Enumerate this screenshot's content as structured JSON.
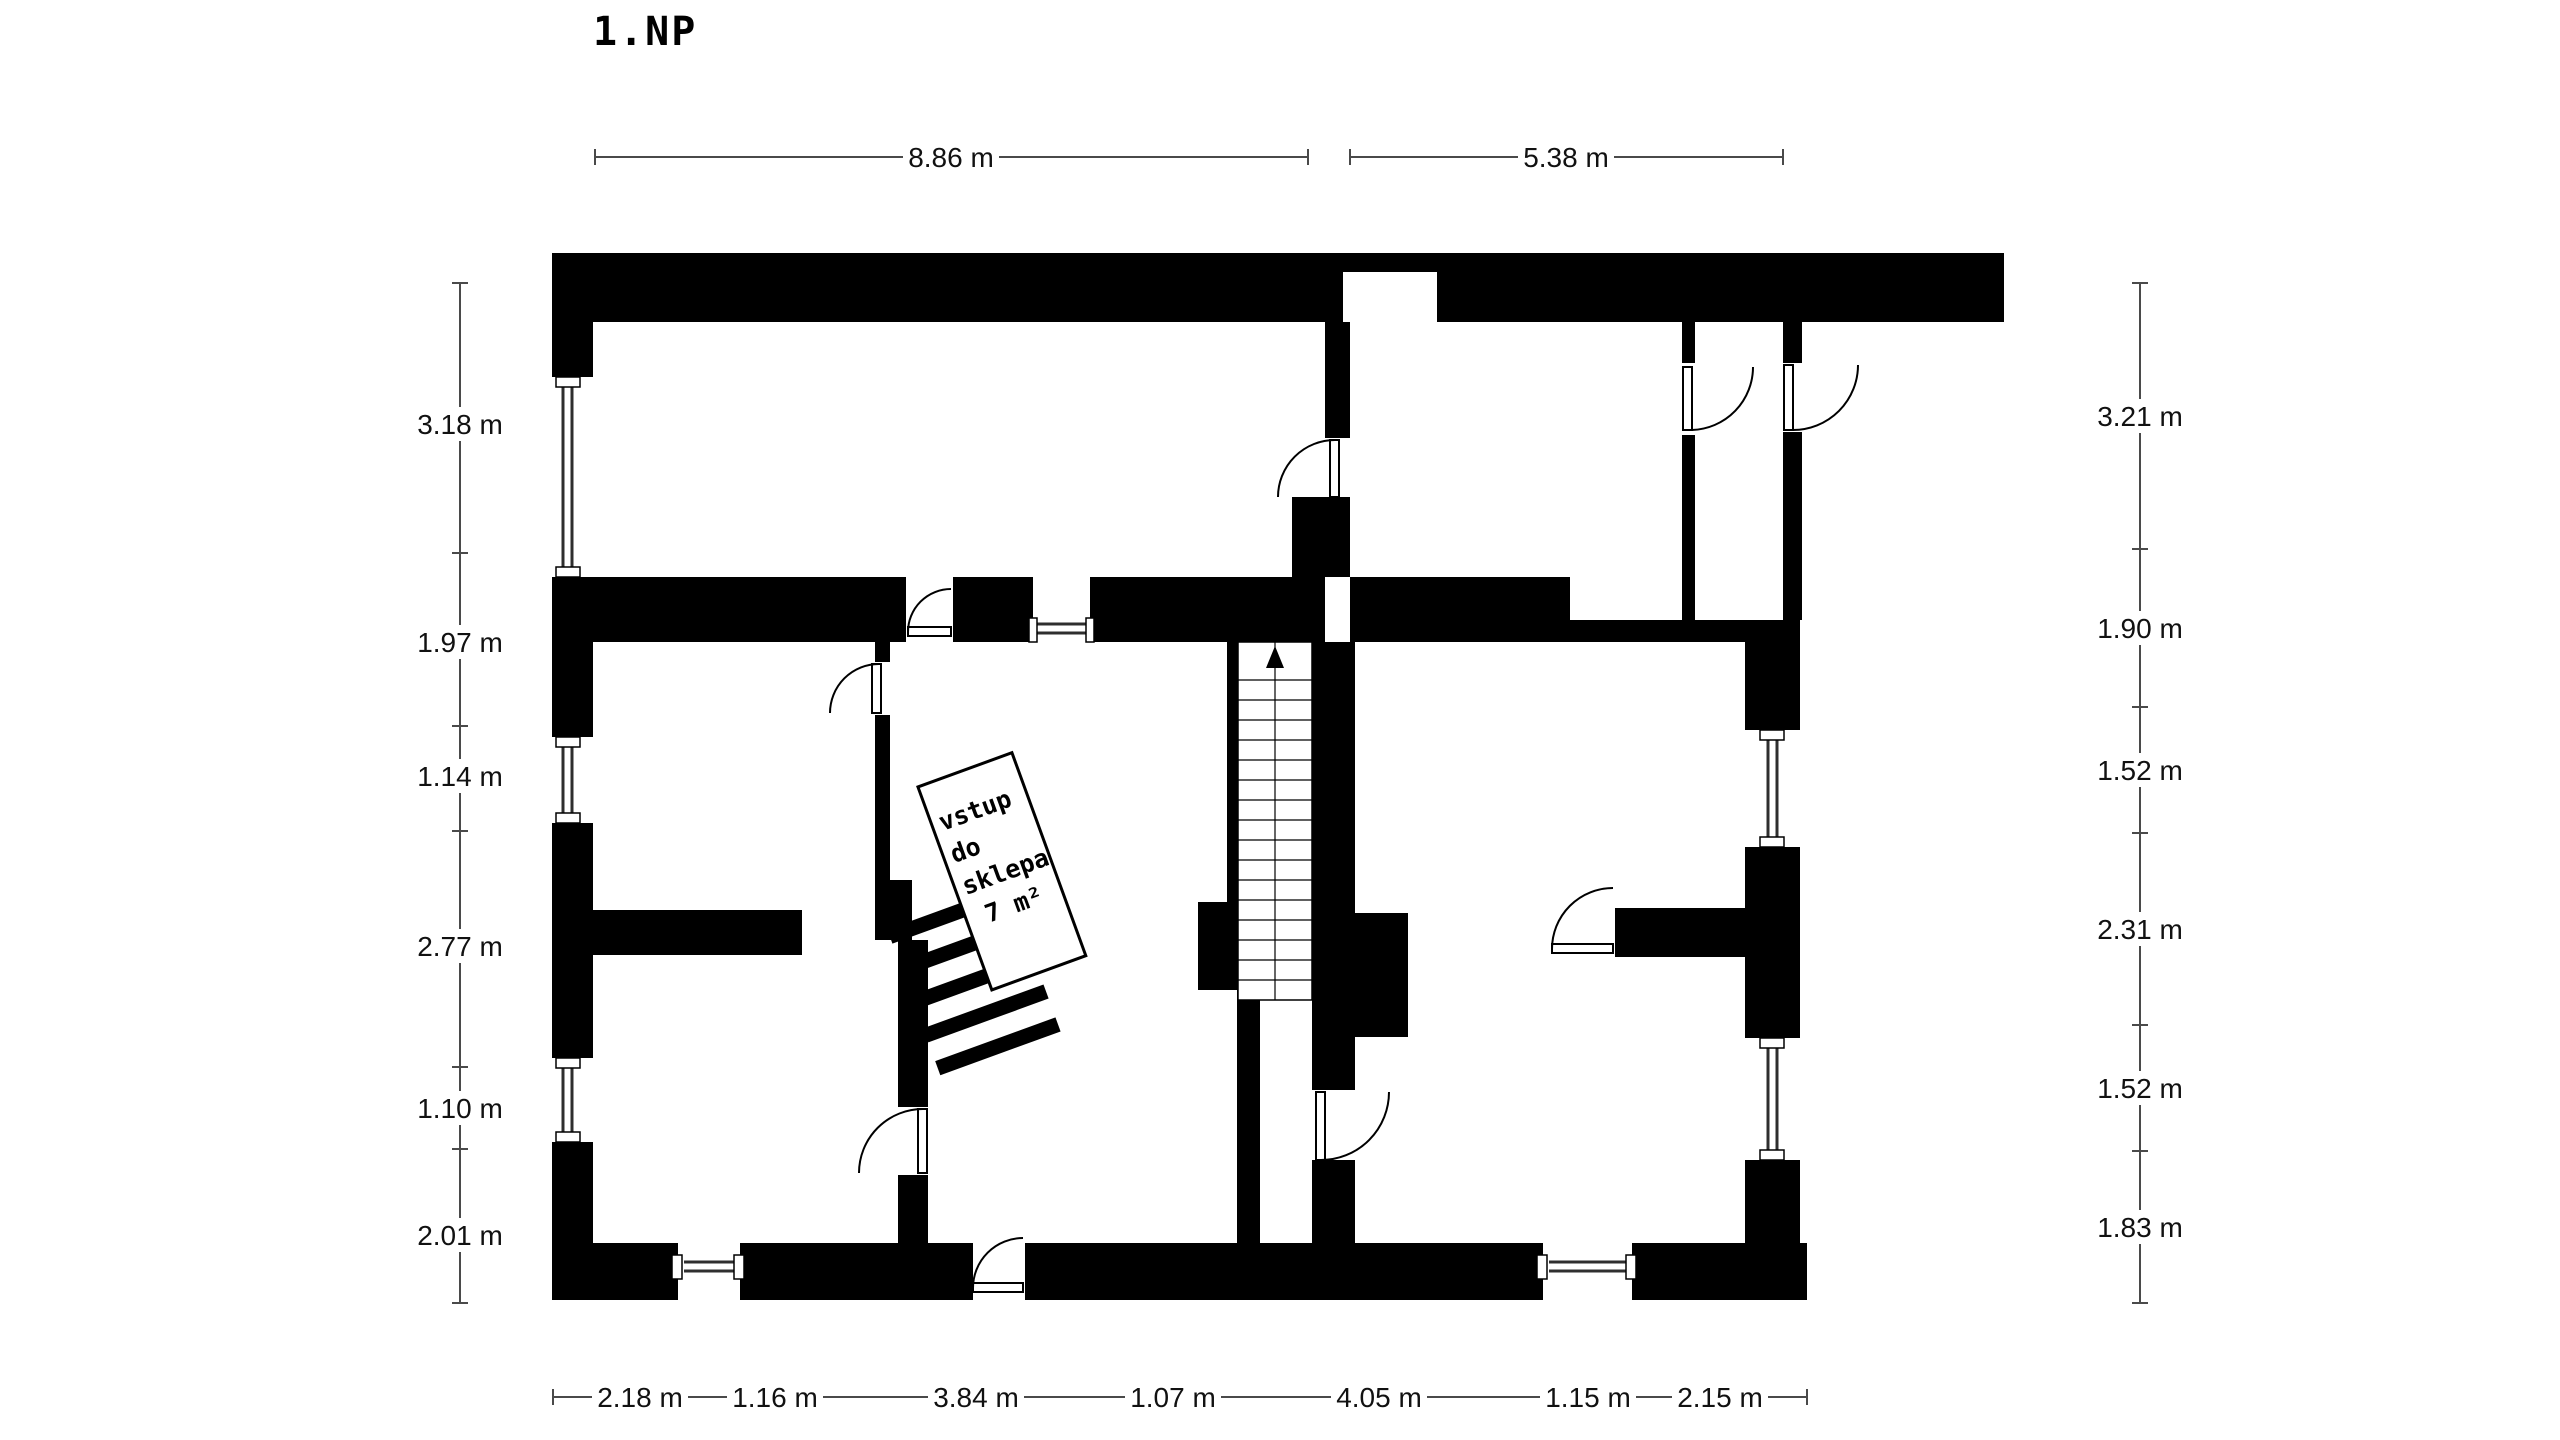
{
  "title": "1.NP",
  "dimensions": {
    "top": [
      {
        "label": "8.86 m",
        "value_m": 8.86
      },
      {
        "label": "5.38 m",
        "value_m": 5.38
      }
    ],
    "left": [
      {
        "label": "3.18 m",
        "value_m": 3.18
      },
      {
        "label": "1.97 m",
        "value_m": 1.97
      },
      {
        "label": "1.14 m",
        "value_m": 1.14
      },
      {
        "label": "2.77 m",
        "value_m": 2.77
      },
      {
        "label": "1.10 m",
        "value_m": 1.1
      },
      {
        "label": "2.01 m",
        "value_m": 2.01
      }
    ],
    "right": [
      {
        "label": "3.21 m",
        "value_m": 3.21
      },
      {
        "label": "1.90 m",
        "value_m": 1.9
      },
      {
        "label": "1.52 m",
        "value_m": 1.52
      },
      {
        "label": "2.31 m",
        "value_m": 2.31
      },
      {
        "label": "1.52 m",
        "value_m": 1.52
      },
      {
        "label": "1.83 m",
        "value_m": 1.83
      }
    ],
    "bottom": [
      {
        "label": "2.18 m",
        "value_m": 2.18
      },
      {
        "label": "1.16 m",
        "value_m": 1.16
      },
      {
        "label": "3.84 m",
        "value_m": 3.84
      },
      {
        "label": "1.07 m",
        "value_m": 1.07
      },
      {
        "label": "4.05 m",
        "value_m": 4.05
      },
      {
        "label": "1.15 m",
        "value_m": 1.15
      },
      {
        "label": "2.15 m",
        "value_m": 2.15
      }
    ]
  },
  "cellar_label": {
    "line1": "vstup",
    "line2": "do",
    "line3": "sklepa",
    "line4": "7 m²",
    "area_m2": 7
  },
  "colors": {
    "walls": "#000000",
    "background": "#ffffff",
    "dimension_lines": "#4a4a4a",
    "text": "#111111"
  }
}
